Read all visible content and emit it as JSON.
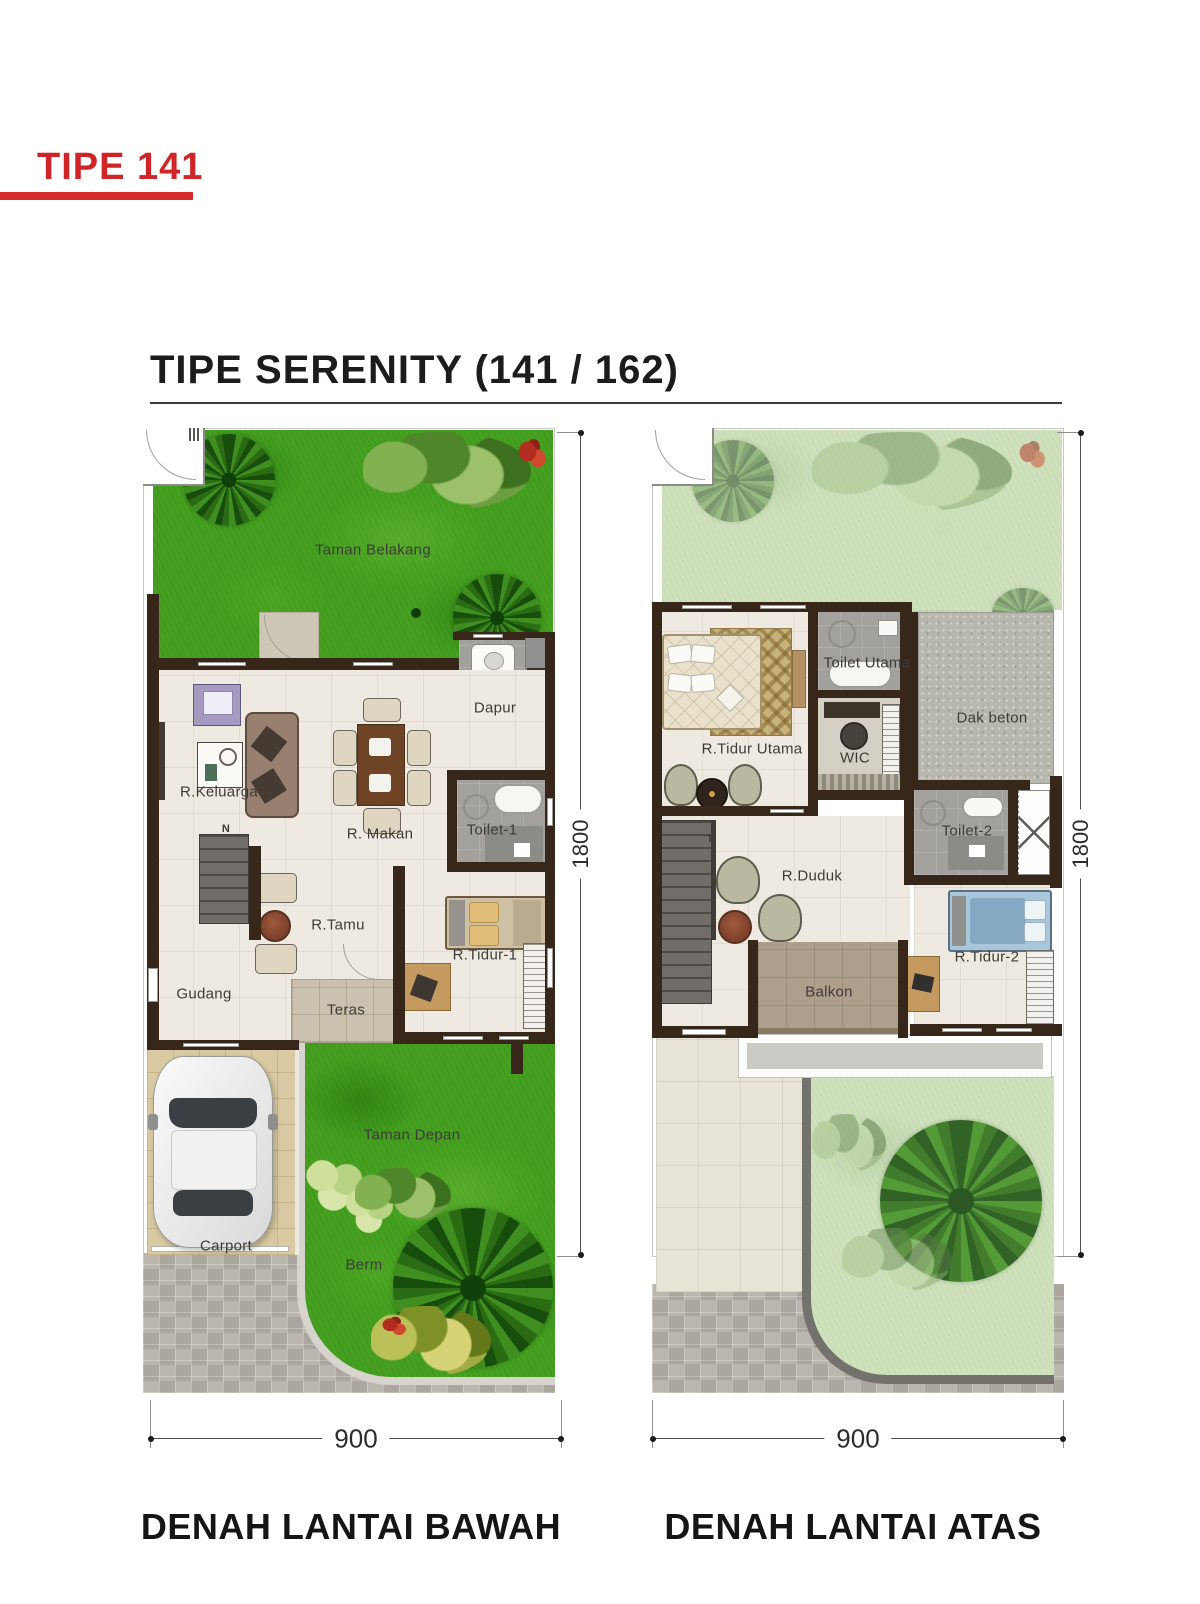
{
  "page": {
    "badge": "TIPE 141",
    "title": "TIPE SERENITY  (141 / 162)"
  },
  "colors": {
    "accent_red": "#cf2428",
    "wall_brown": "#37261a",
    "grass_bright": "#45a11f",
    "grass_pale": "#cfe1bd",
    "floor_cream": "#eeeae1",
    "tile_gray": "#a2a19d",
    "concrete_gray": "#b7b7ae"
  },
  "floor_lower": {
    "caption": "DENAH LANTAI BAWAH",
    "dim_width": "900",
    "dim_depth": "1800",
    "stairs_note": "N",
    "rooms": {
      "taman_belakang": "Taman Belakang",
      "dapur": "Dapur",
      "r_keluarga": "R.Keluarga",
      "r_makan": "R. Makan",
      "toilet_1": "Toilet-1",
      "r_tamu": "R.Tamu",
      "r_tidur_1": "R.Tidur-1",
      "gudang": "Gudang",
      "teras": "Teras",
      "carport": "Carport",
      "taman_depan": "Taman Depan",
      "berm": "Berm"
    }
  },
  "floor_upper": {
    "caption": "DENAH LANTAI ATAS",
    "dim_width": "900",
    "dim_depth": "1800",
    "stairs_note": "T",
    "rooms": {
      "r_tidur_utama": "R.Tidur Utama",
      "toilet_utama": "Toilet Utama",
      "wic": "WIC",
      "dak_beton": "Dak beton",
      "toilet_2": "Toilet-2",
      "r_duduk": "R.Duduk",
      "balkon": "Balkon",
      "r_tidur_2": "R.Tidur-2"
    }
  }
}
